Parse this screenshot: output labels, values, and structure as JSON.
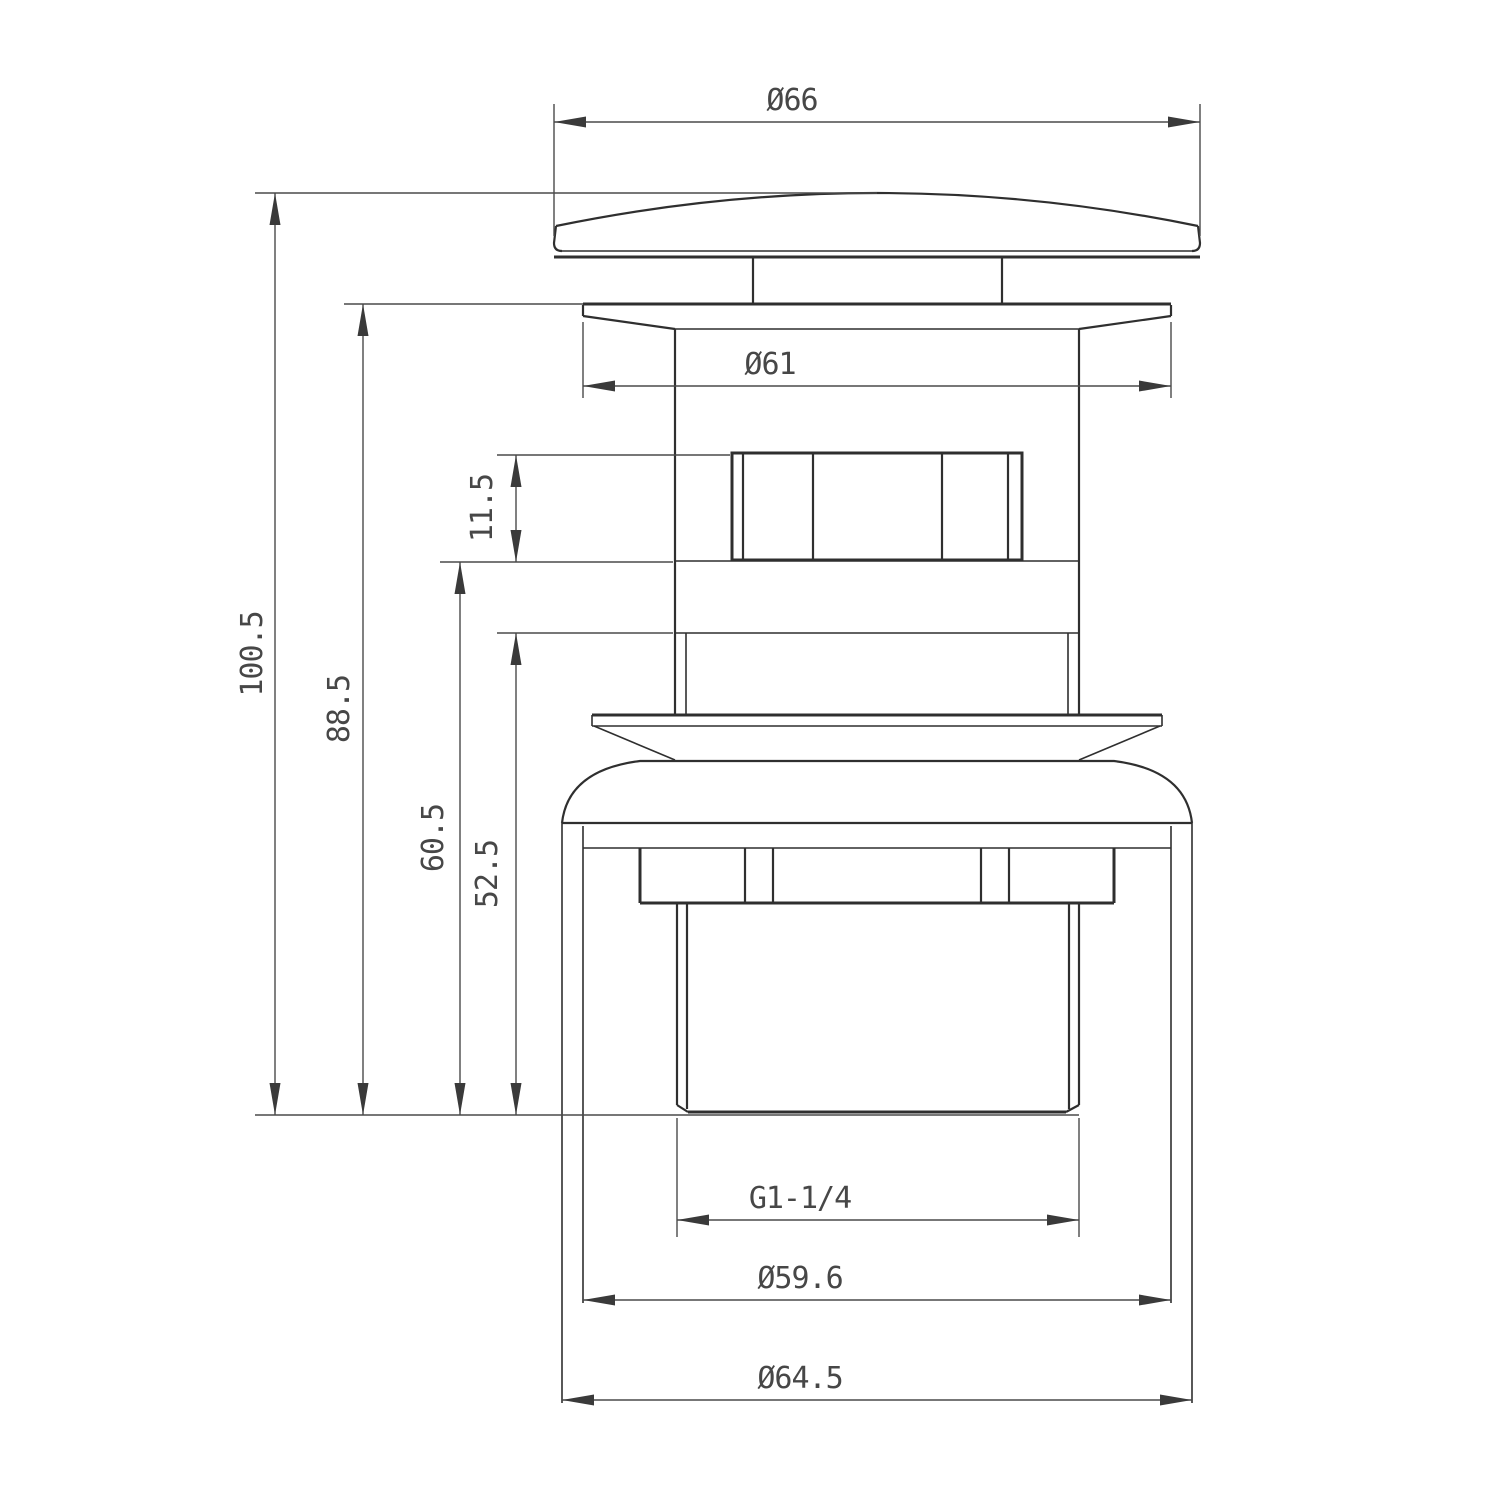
{
  "drawing": {
    "background": "#ffffff",
    "object_line_color": "#2f2f2f",
    "dimension_line_color": "#4a4a4a",
    "dimensions": {
      "cap_diameter": "Ø66",
      "flange_diameter": "Ø61",
      "overall_height": "100.5",
      "height_below_cap": "88.5",
      "hex_collar_height": "11.5",
      "lower_body_height": "60.5",
      "tail_section_height": "52.5",
      "thread_size": "G1-1/4",
      "body_inner_diameter": "Ø59.6",
      "body_outer_diameter": "Ø64.5"
    }
  }
}
